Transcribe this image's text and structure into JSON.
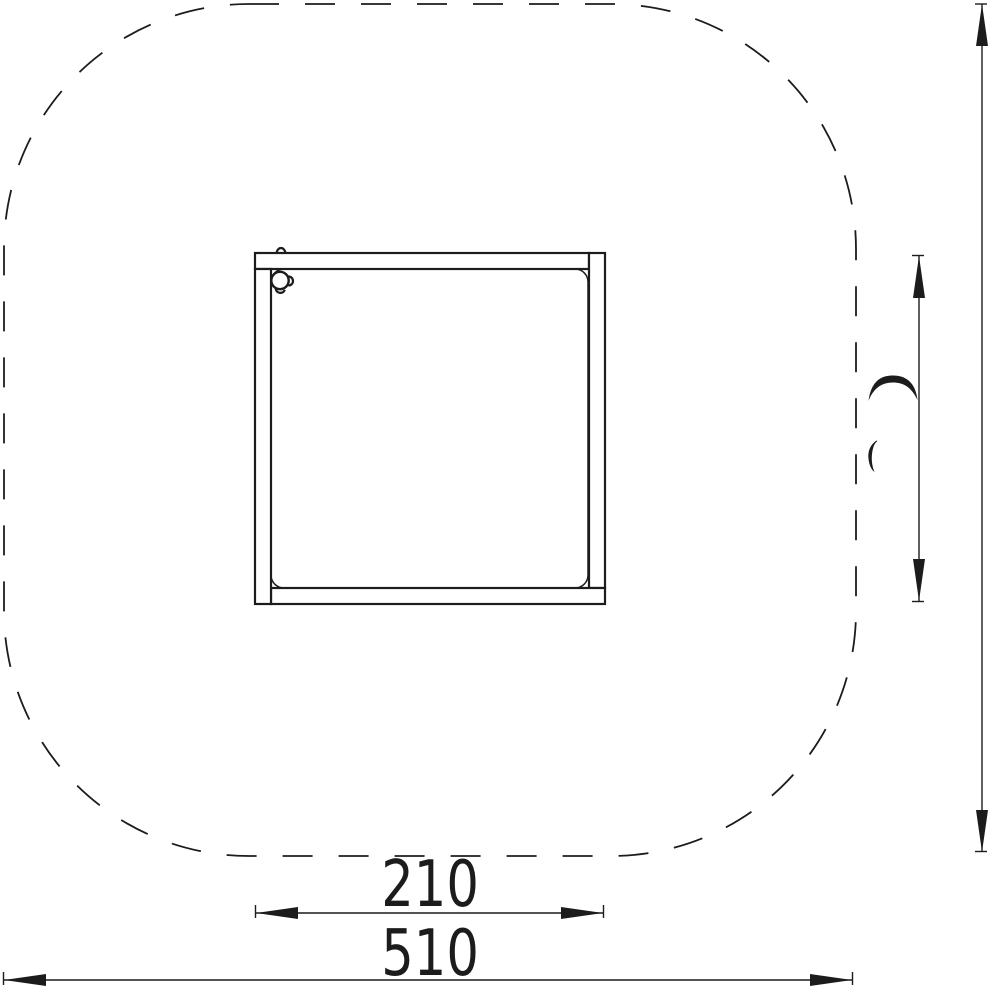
{
  "colors": {
    "ink": "#1c1c1c",
    "paper": "#ffffff"
  },
  "drawing": {
    "safety_zone": {
      "shape": "dashed rounded-square outline"
    },
    "product": {
      "shape": "square plank frame, top view",
      "detail": "corner cap with lugs"
    }
  },
  "dimensions": {
    "product_width": {
      "label": "210",
      "orientation": "horizontal"
    },
    "zone_width": {
      "label": "510",
      "orientation": "horizontal"
    },
    "product_height": {
      "label": "210",
      "orientation": "vertical",
      "rendered": "partial glyph fragments"
    },
    "zone_height": {
      "orientation": "vertical",
      "rendered": "no visible label"
    }
  }
}
